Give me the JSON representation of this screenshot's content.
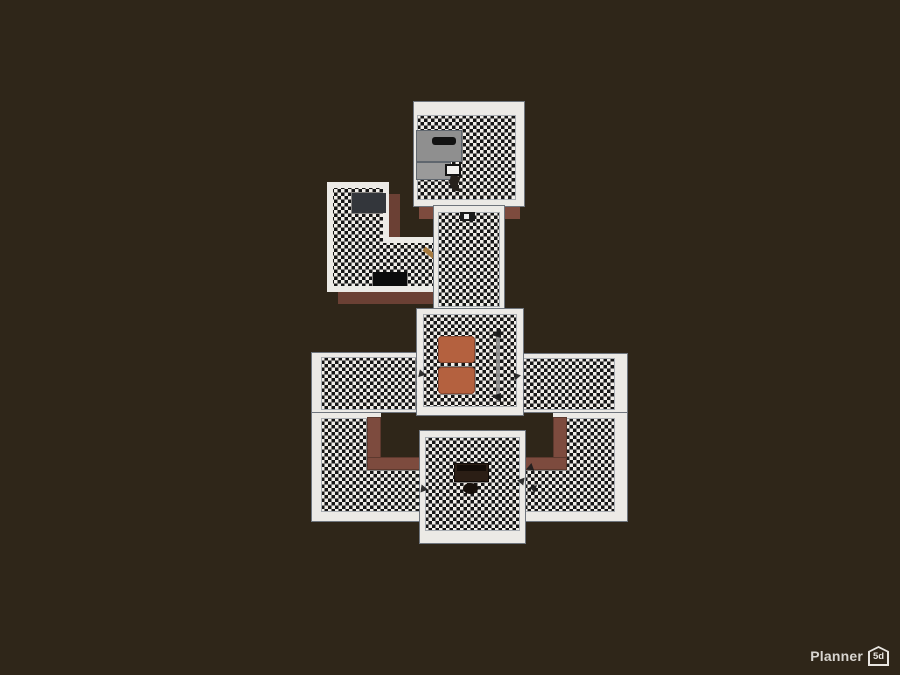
{
  "app": {
    "name": "Planner 5D",
    "logo": {
      "text": "Planner",
      "badge": "5d"
    }
  },
  "colors": {
    "background": "#2f2619",
    "wall": "#eceae6",
    "wallEdge": "#6f757d",
    "floorBase": "#f1eee9",
    "floorCheck": "#161616",
    "exteriorWall": "#7d4b3e",
    "shadowWall": "#6b4034",
    "accentOrange": "#b4613f",
    "counterGray": "#8f8f8f",
    "darkFurniture": "#2b1e15",
    "logoText": "#d8d5d0"
  },
  "scene": {
    "view": "top-down-3d-floor-plan",
    "floor_pattern": "black-white-checkerboard",
    "rooms": [
      {
        "id": "bathroom-top",
        "furniture": [
          "gray-cabinet",
          "gray-counter",
          "toilet"
        ]
      },
      {
        "id": "corridor",
        "furniture": [
          "wall-fixture"
        ]
      },
      {
        "id": "l-shaped-room",
        "furniture": [
          "dresser",
          "black-sofa",
          "door-leaf"
        ]
      },
      {
        "id": "center-room",
        "furniture": [
          "orange-armchair",
          "orange-armchair",
          "long-bar"
        ]
      },
      {
        "id": "left-wing-room",
        "furniture": []
      },
      {
        "id": "right-wing-room",
        "furniture": []
      },
      {
        "id": "bottom-u-room",
        "furniture": []
      },
      {
        "id": "office-room",
        "furniture": [
          "desk",
          "office-chair"
        ]
      }
    ]
  }
}
